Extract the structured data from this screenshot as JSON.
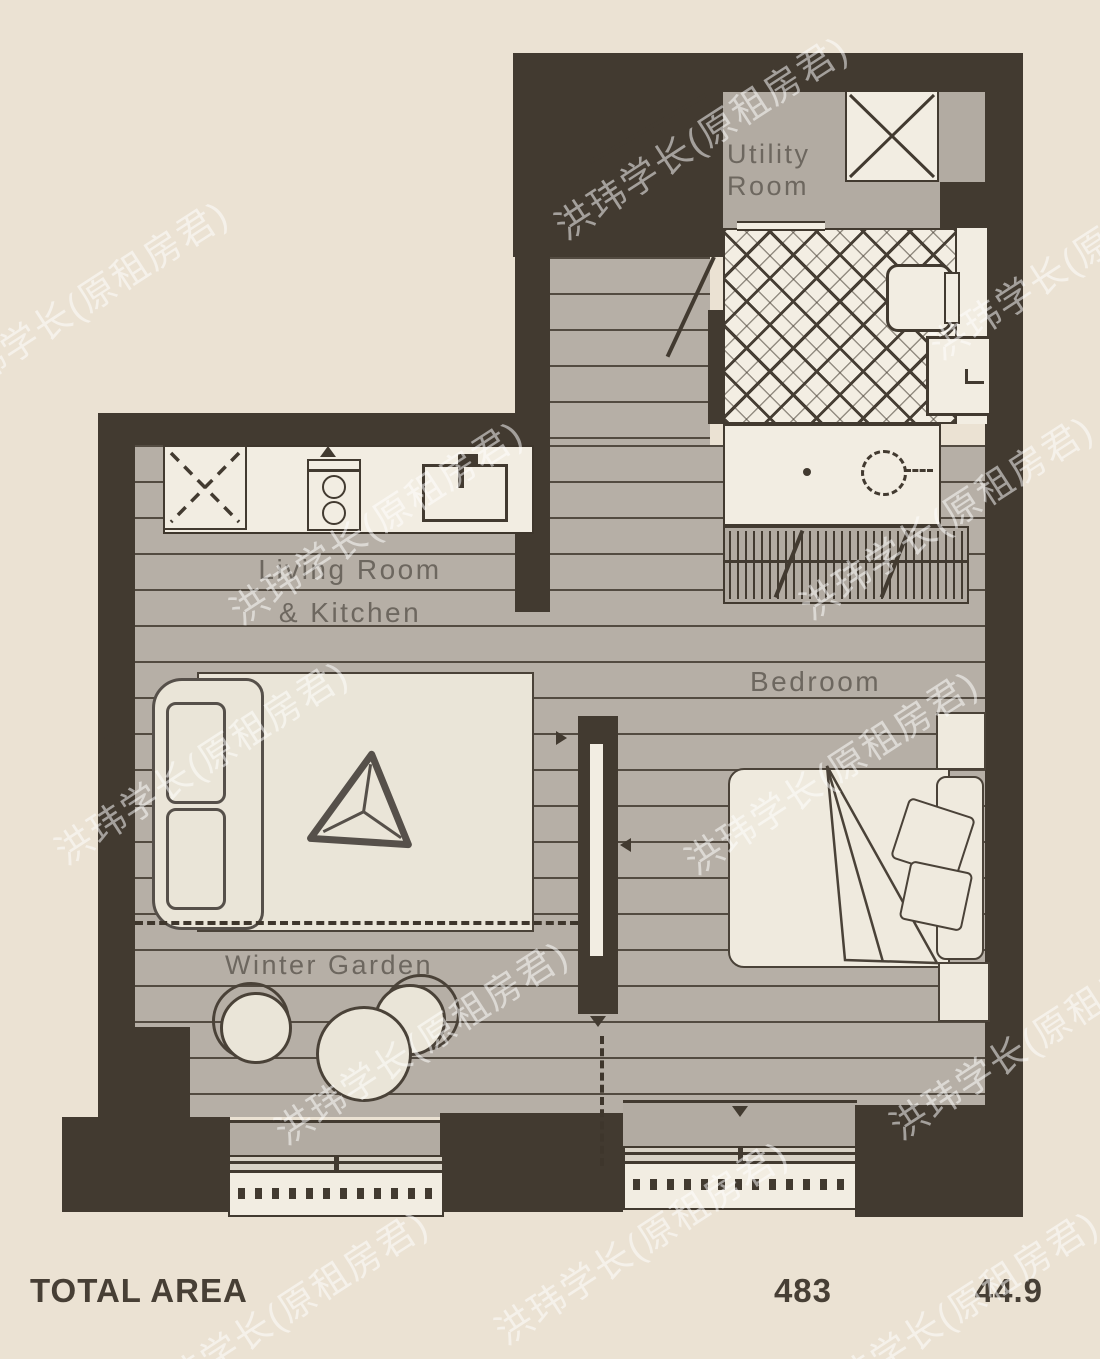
{
  "rooms": {
    "utility": {
      "line1": "Utility",
      "line2": "Room"
    },
    "living": {
      "line1": "Living Room",
      "line2": "& Kitchen"
    },
    "bedroom": {
      "label": "Bedroom"
    },
    "winter_garden": {
      "label": "Winter Garden"
    }
  },
  "footer": {
    "label": "TOTAL AREA",
    "area_sqft": "483",
    "area_sqm": "44.9"
  },
  "watermark": {
    "text": "洪玮学长(原租房君)"
  },
  "colors": {
    "background": "#ebe2d3",
    "wall": "#423a30",
    "floor": "#b6afa6",
    "tile_fill": "#f3eee3",
    "furniture_fill": "#f2ede2",
    "label_text": "#6d675f",
    "footer_text": "#473f35"
  }
}
